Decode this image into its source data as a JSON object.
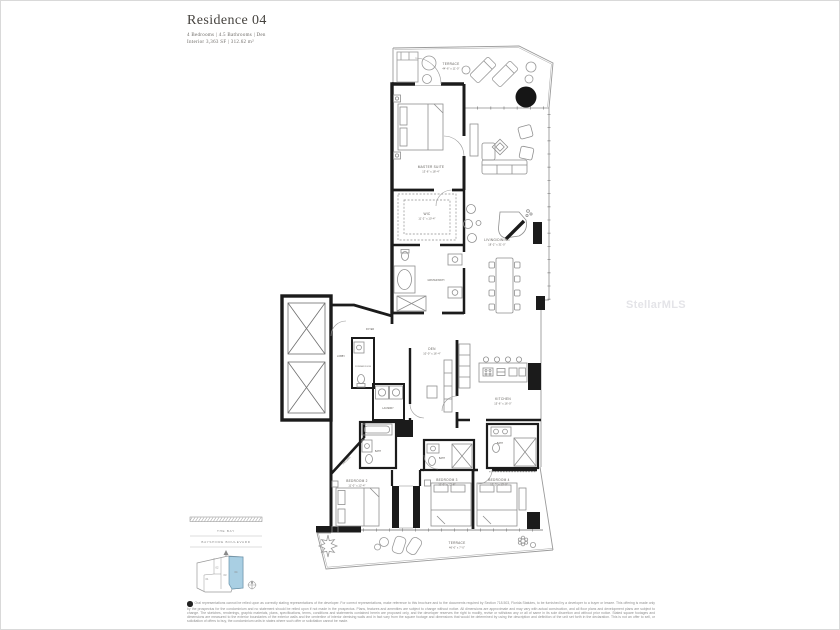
{
  "page": {
    "title": "Residence 04",
    "specs": "4 Bedrooms  |  4.5 Bathrooms  |  Den",
    "area": "Interior 3,363 SF  |  312.62 m²"
  },
  "watermark": {
    "text": "StellarMLS"
  },
  "floorplan": {
    "rooms": {
      "terrace_top": {
        "label": "TERRACE",
        "dims": "44'-6\" x 11'-0\""
      },
      "master": {
        "label": "MASTER SUITE",
        "dims": "13'-6\" x 18'-4\""
      },
      "living": {
        "label": "LIVING/DINING",
        "dims": "18'-2\" x 31'-0\""
      },
      "wic": {
        "label": "WIC",
        "dims": "11'-2\" x 10'-4\""
      },
      "master_bath": {
        "label": "MASTER BATH"
      },
      "den": {
        "label": "DEN",
        "dims": "10'-0\" x 16'-4\""
      },
      "kitchen": {
        "label": "KITCHEN",
        "dims": "15'-6\" x 16'-0\""
      },
      "lobby": {
        "label": "LOBBY"
      },
      "foyer": {
        "label": "FOYER"
      },
      "powder": {
        "label": "POWDER ROOM"
      },
      "laundry": {
        "label": "LAUNDRY"
      },
      "gallery": {
        "label": "GALLERY"
      },
      "bath2": {
        "label": "BATH"
      },
      "bath3": {
        "label": "BATH"
      },
      "bath4": {
        "label": "BATH"
      },
      "bedroom2": {
        "label": "BEDROOM 2",
        "dims": "11'-0\" x 12'-4\""
      },
      "bedroom3": {
        "label": "BEDROOM 3",
        "dims": "11'-0\" x 12'-8\""
      },
      "bedroom4": {
        "label": "BEDROOM 4",
        "dims": "12'-0\" x 13'-0\""
      },
      "terrace_bottom": {
        "label": "TERRACE",
        "dims": "46'-0\" x 7'-0\""
      }
    }
  },
  "keyplan": {
    "street_top": "THE BAY",
    "street_bottom": "BAYSHORE BOULEVARD",
    "units": [
      "01",
      "02",
      "03",
      "04"
    ],
    "highlighted_unit": "04",
    "highlight_color": "#a9cfe3"
  },
  "disclaimer": {
    "text": "Oral representations cannot be relied upon as correctly stating representations of the developer. For correct representations, make reference to this brochure and to the documents required by Section 718.503, Florida Statutes, to be furnished by a developer to a buyer or lessee. This offering is made only by the prospectus for the condominium and no statement should be relied upon if not made in the prospectus. Plans, features and amenities are subject to change without notice. All dimensions are approximate and may vary with actual construction, and all floor plans and development plans are subject to change. The sketches, renderings, graphic materials, plans, specifications, terms, conditions and statements contained herein are proposed only, and the developer reserves the right to modify, revise or withdraw any or all of same in its sole discretion and without prior notice. Stated square footages and dimensions are measured to the exterior boundaries of the exterior walls and the centerline of interior demising walls and in fact vary from the square footage and dimensions that would be determined by using the description and definition of the unit set forth in the declaration. This is not an offer to sell, or solicitation of offers to buy, the condominium units in states where such offer or solicitation cannot be made."
  }
}
